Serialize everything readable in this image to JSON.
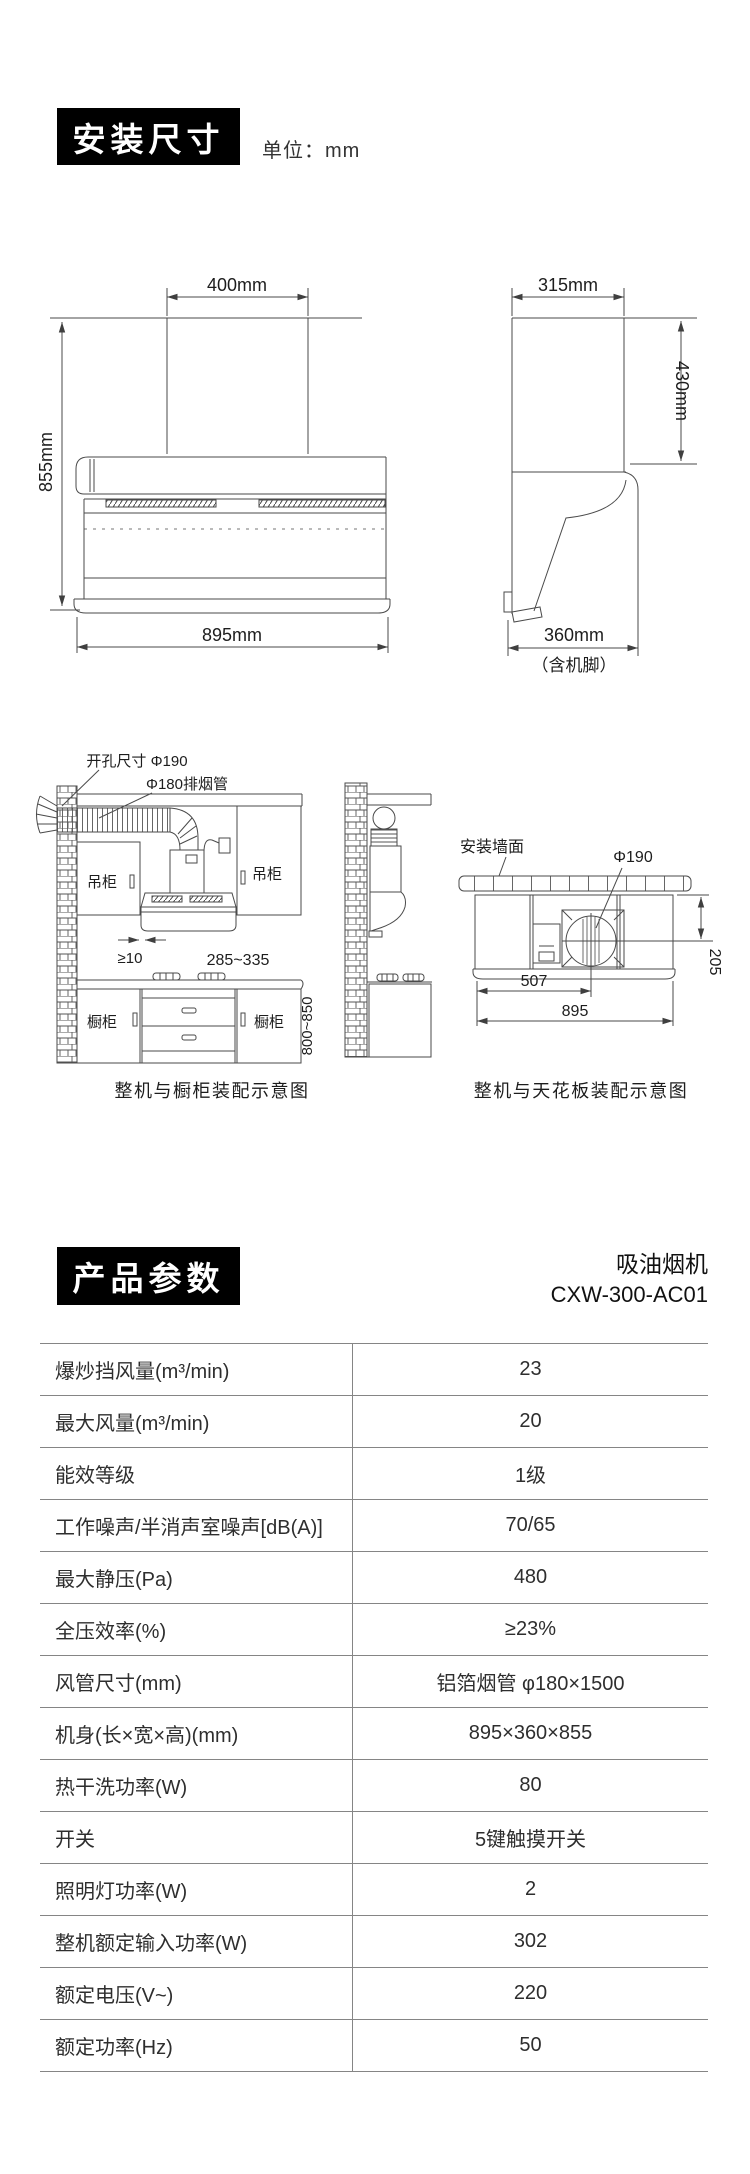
{
  "section_install": {
    "title": "安装尺寸",
    "unit_label": "单位：mm",
    "front_view": {
      "dim_width_top": "400mm",
      "dim_height": "855mm",
      "dim_width_bottom": "895mm"
    },
    "side_view": {
      "dim_width_top": "315mm",
      "dim_height": "430mm",
      "dim_depth": "360mm",
      "dim_depth_note": "（含机脚）"
    }
  },
  "section_assembly": {
    "cabinet_diagram": {
      "label_hole": "开孔尺寸 Φ190",
      "label_duct": "Φ180排烟管",
      "label_wall_cabinet_left": "吊柜",
      "label_wall_cabinet_right": "吊柜",
      "dim_gap": "≥10",
      "dim_hood_height": "285~335",
      "label_base_cabinet_left": "橱柜",
      "label_base_cabinet_right": "橱柜",
      "dim_counter_height": "800~850",
      "caption": "整机与橱柜装配示意图"
    },
    "ceiling_diagram": {
      "label_wall": "安装墙面",
      "label_hole": "Φ190",
      "dim_left": "507",
      "dim_width": "895",
      "dim_depth": "205",
      "caption": "整机与天花板装配示意图"
    }
  },
  "section_params": {
    "title": "产品参数",
    "product_type": "吸油烟机",
    "model": "CXW-300-AC01",
    "rows": [
      {
        "label": "爆炒挡风量(m³/min)",
        "value": "23"
      },
      {
        "label": "最大风量(m³/min)",
        "value": "20"
      },
      {
        "label": "能效等级",
        "value": "1级"
      },
      {
        "label": "工作噪声/半消声室噪声[dB(A)]",
        "value": "70/65"
      },
      {
        "label": "最大静压(Pa)",
        "value": "480"
      },
      {
        "label": "全压效率(%)",
        "value": "≥23%"
      },
      {
        "label": "风管尺寸(mm)",
        "value": "铝箔烟管 φ180×1500"
      },
      {
        "label": "机身(长×宽×高)(mm)",
        "value": "895×360×855"
      },
      {
        "label": "热干洗功率(W)",
        "value": "80"
      },
      {
        "label": "开关",
        "value": "5键触摸开关"
      },
      {
        "label": "照明灯功率(W)",
        "value": "2"
      },
      {
        "label": "整机额定输入功率(W)",
        "value": "302"
      },
      {
        "label": "额定电压(V~)",
        "value": "220"
      },
      {
        "label": "额定功率(Hz)",
        "value": "50"
      }
    ]
  }
}
